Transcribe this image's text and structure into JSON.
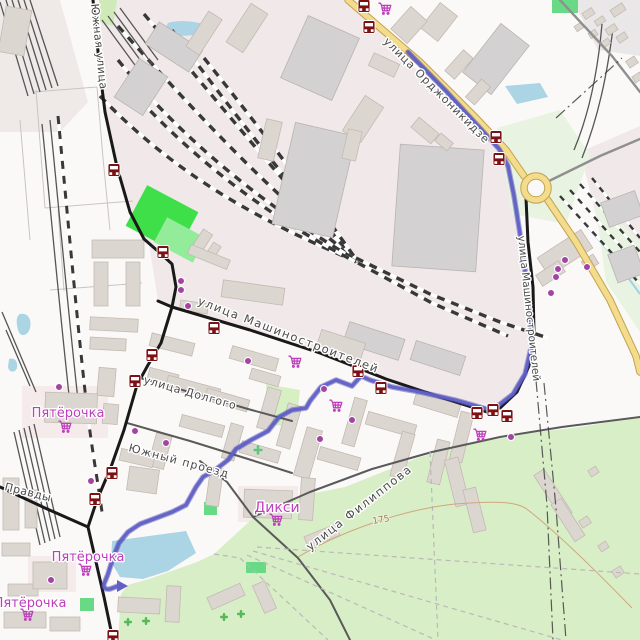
{
  "colors": {
    "bg": "#fbf9f8",
    "industrial": "#f1e9e9",
    "water": "#abd4e4",
    "stream": "#9fd4e4",
    "park": "#d8eec7",
    "pale_green": "#e9f3e1",
    "building": "#dcd6d1",
    "building_stroke": "#c3bab2",
    "industrial_building": "#d3d1d1",
    "industrial_building_stroke": "#b9b4b1",
    "road_black": "#191919",
    "road_minor": "#5a5a5a",
    "road_gray": "#8f8f8f",
    "road_yellow": "#f4dc8d",
    "road_yellow_casing": "#c2a24f",
    "rail_dark": "#383838",
    "rail_thin": "#555555",
    "route": "#6060c8",
    "route_casing": "#3e3ea8",
    "poi_purple": "#a344a3",
    "shop_label": "#bc3fbc",
    "bus_icon": "#7c1013",
    "street_label": "#4a4a4a",
    "boundary": "#3f3f3f",
    "field_path": "#c9c4bf",
    "contour": "#cfa87c",
    "contour_label": "#a87a4e",
    "green_icon": "#57b857",
    "playground_icon": "#57c87a",
    "field_green": "#3fdf4a",
    "field_green_light": "#93ec9a",
    "green_patch": "#68da86",
    "hedge": "#cfeab8",
    "hedge2": "#d6f0c4",
    "zone_retail": "#f5ebea",
    "zone_gray": "#e9e7e7",
    "zone_nw": "#efeae8"
  },
  "street_labels": [
    {
      "text": "Южная улица",
      "x": 91,
      "y": 4,
      "rot": 84,
      "size": 11,
      "ls": 0.5
    },
    {
      "text": "улица Орджоникидзе",
      "x": 383,
      "y": 42,
      "rot": 45,
      "size": 11,
      "ls": 1
    },
    {
      "text": "улица Машиностроителей",
      "x": 197,
      "y": 304,
      "rot": 21,
      "size": 11.5,
      "ls": 1.5
    },
    {
      "text": "улица Машиностроителей",
      "x": 518,
      "y": 236,
      "rot": 84,
      "size": 10.5,
      "ls": 0
    },
    {
      "text": "улица Долгого",
      "x": 143,
      "y": 383,
      "rot": 16,
      "size": 11,
      "ls": 0.8
    },
    {
      "text": "Южный проезд",
      "x": 128,
      "y": 451,
      "rot": 15,
      "size": 11,
      "ls": 1.2
    },
    {
      "text": "Правды",
      "x": 4,
      "y": 490,
      "rot": 14,
      "size": 11,
      "ls": 0.5
    },
    {
      "text": "улица Филиппова",
      "x": 310,
      "y": 551,
      "rot": -38,
      "size": 11.5,
      "ls": 1.5
    }
  ],
  "shop_labels": [
    {
      "text": "Пятёрочка",
      "x": 68,
      "y": 417,
      "size": 13
    },
    {
      "text": "Пятёрочка",
      "x": 88,
      "y": 561,
      "size": 13
    },
    {
      "text": "Пятёрочка",
      "x": 30,
      "y": 607,
      "size": 13
    },
    {
      "text": "Дикси",
      "x": 277,
      "y": 512,
      "size": 14
    }
  ],
  "carts": [
    [
      385,
      10
    ],
    [
      295,
      363
    ],
    [
      336,
      407
    ],
    [
      480,
      436
    ],
    [
      65,
      428
    ],
    [
      85,
      571
    ],
    [
      27,
      616
    ],
    [
      276,
      521
    ]
  ],
  "shop_dots": [
    [
      181,
      281
    ],
    [
      181,
      290
    ],
    [
      188,
      306
    ],
    [
      248,
      361
    ],
    [
      324,
      389
    ],
    [
      352,
      420
    ],
    [
      320,
      439
    ],
    [
      511,
      437
    ],
    [
      565,
      260
    ],
    [
      558,
      269
    ],
    [
      556,
      277
    ],
    [
      587,
      267
    ],
    [
      551,
      293
    ],
    [
      59,
      387
    ],
    [
      135,
      431
    ],
    [
      166,
      443
    ],
    [
      91,
      481
    ],
    [
      51,
      580
    ]
  ],
  "bus_stops": [
    [
      364,
      6
    ],
    [
      369,
      27
    ],
    [
      496,
      137
    ],
    [
      499,
      159
    ],
    [
      114,
      170
    ],
    [
      163,
      252
    ],
    [
      214,
      328
    ],
    [
      152,
      355
    ],
    [
      358,
      371
    ],
    [
      381,
      388
    ],
    [
      135,
      381
    ],
    [
      112,
      473
    ],
    [
      95,
      499
    ],
    [
      477,
      413
    ],
    [
      493,
      410
    ],
    [
      507,
      416
    ],
    [
      113,
      636
    ]
  ],
  "route": {
    "d": "M408,52 L445,90 L478,126 L499,149 L508,166 L514,196 L521,240 L527,285 L531,325 L531,348 L525,374 L513,394 L499,405 L487,409 L455,400 L420,392 L392,387 L370,380 L361,376 L352,386 L336,380 L321,387 L310,401 L306,408 L292,410 L279,417 L268,431 L251,440 L236,449 L228,460 L215,470 L203,477 L196,487 L186,505 L172,512 L156,518 L140,524 L128,532 L119,543 L113,558 L108,574 L104,584 Q103,590 110,589 L118,586",
    "arrow": "117,580 128,586 117,592"
  },
  "contour": {
    "d": "M298,557 C340,532 400,510 455,504 C505,500 520,503 528,510 C560,535 600,575 632,608",
    "label": "175",
    "x": 373,
    "y": 524,
    "rot": -10
  },
  "areas": [
    {
      "d": "M100,0 L348,0 L492,146 L506,161 L521,232 L534,330 L520,382 L496,406 L440,397 L386,379 L250,330 L172,307 L158,301 L149,244 L130,212 L117,167 L104,112 Z",
      "f": "industrial"
    },
    {
      "d": "M580,152 L640,126 L640,264 L598,222 Z",
      "f": "industrial"
    },
    {
      "d": "M0,0 L60,0 L88,102 L60,132 L0,132 Z",
      "f": "zone_nw"
    },
    {
      "d": "M572,0 L640,0 L640,56 L598,50 Z",
      "f": "zone_gray"
    },
    {
      "d": "M22,386 L108,386 L108,438 L22,438 Z",
      "f": "zone_retail"
    },
    {
      "d": "M28,556 L76,556 L76,592 L28,592 Z",
      "f": "zone_retail"
    },
    {
      "d": "M238,486 L298,486 L298,522 L238,522 Z",
      "f": "zone_retail"
    },
    {
      "d": "M118,640 L121,594 L128,585 L152,578 L197,562 L214,554 L252,519 L300,496 L345,487 L420,457 L470,444 L530,433 L580,427 L640,417 L640,640 Z",
      "f": "park"
    },
    {
      "d": "M497,128 L560,110 L590,155 L566,224 L512,214 Z",
      "f": "pale_green"
    },
    {
      "d": "M594,196 L640,242 L640,332 L606,282 Z",
      "f": "pale_green"
    },
    {
      "d": "M540,505 L556,478 L582,600 L585,640 L548,640 Z",
      "f": "park"
    },
    {
      "d": "M572,520 L594,504 L614,570 L594,614 Z",
      "f": "park"
    }
  ],
  "hedges": [
    {
      "d": "M99,0 L117,0 L113,26 L99,22 Z",
      "f": "hedge"
    },
    {
      "d": "M266,384 L300,390 L296,428 L268,424 Z",
      "f": "hedge2"
    }
  ],
  "green_rects": [
    [
      133,
      196,
      58,
      46,
      28,
      "field_green"
    ],
    [
      158,
      226,
      44,
      28,
      28,
      "field_green_light"
    ],
    [
      552,
      0,
      26,
      13,
      0,
      "green_patch"
    ],
    [
      204,
      502,
      13,
      13,
      0,
      "green_patch"
    ],
    [
      246,
      562,
      20,
      11,
      0,
      "green_patch"
    ],
    [
      80,
      598,
      14,
      13,
      0,
      "green_patch"
    ]
  ],
  "trees": [
    [
      128,
      622
    ],
    [
      146,
      621
    ],
    [
      224,
      617
    ],
    [
      241,
      614
    ]
  ],
  "playgrounds": [
    [
      258,
      450
    ]
  ],
  "water": [
    {
      "d": "M112,541 L186,531 L196,553 L168,571 L143,579 L120,577 L111,562 Z"
    },
    {
      "d": "M168,23 C180,19 205,22 211,28 C206,35 186,37 172,35 C166,32 165,27 168,23 Z"
    },
    {
      "d": "M505,86 L540,83 L548,97 L517,104 Z"
    },
    {
      "d": "M20,314 C28,312 32,320 30,328 C28,336 20,338 18,330 C16,322 16,316 20,314 Z"
    },
    {
      "d": "M9,359 C15,357 18,362 17,368 C15,373 9,373 8,367 Z"
    }
  ],
  "streams": [
    "M576,214 L608,250 L640,294"
  ],
  "rails": [
    {
      "d": "M118,26 C200,118 282,205 356,259",
      "t": "y"
    },
    {
      "d": "M144,14 C226,112 300,203 356,259",
      "t": "y"
    },
    {
      "d": "M172,30 C240,122 308,208 357,261",
      "t": "y"
    },
    {
      "d": "M204,58 C262,130 320,208 358,262",
      "t": "y"
    },
    {
      "d": "M118,60 C190,150 280,215 356,260",
      "t": "y"
    },
    {
      "d": "M100,96 C180,180 270,225 355,261",
      "t": "y"
    },
    {
      "d": "M140,100 C210,175 286,226 356,262",
      "t": "y"
    },
    {
      "d": "M356,258 L430,294 L500,322 L548,338",
      "t": "y"
    },
    {
      "d": "M358,263 L432,303 L508,336",
      "t": "y"
    },
    {
      "d": "M560,196 L640,284",
      "t": "c"
    },
    {
      "d": "M570,190 L640,268",
      "t": "c"
    },
    {
      "d": "M580,184 L640,252",
      "t": "c"
    },
    {
      "d": "M592,178 L640,238",
      "t": "c"
    },
    {
      "d": "M602,24 C598,70 590,112 574,150",
      "t": "s"
    },
    {
      "d": "M613,28 C607,76 598,118 582,158",
      "t": "s"
    },
    {
      "d": "M58,116 C68,220 76,310 86,400 C92,452 98,482 102,512",
      "t": "m"
    },
    {
      "d": "M50,120 C60,220 68,310 78,400",
      "t": "s"
    },
    {
      "d": "M42,124 C52,224 60,314 70,404",
      "t": "s"
    },
    {
      "d": "M14,432 L40,545",
      "t": "s"
    },
    {
      "d": "M19,430 L45,543",
      "t": "s"
    },
    {
      "d": "M24,428 L50,541",
      "t": "s"
    },
    {
      "d": "M29,426 L55,539",
      "t": "s"
    },
    {
      "d": "M34,424 L60,537",
      "t": "s"
    },
    {
      "d": "M0,2 L28,96",
      "t": "s"
    },
    {
      "d": "M6,0 L34,94",
      "t": "s"
    },
    {
      "d": "M12,0 L40,92",
      "t": "s"
    },
    {
      "d": "M18,0 L46,90",
      "t": "s"
    },
    {
      "d": "M24,0 L52,88",
      "t": "s"
    },
    {
      "d": "M30,0 L58,86",
      "t": "s"
    },
    {
      "d": "M102,20 L140,72",
      "t": "s"
    },
    {
      "d": "M108,16 L146,68",
      "t": "s"
    },
    {
      "d": "M114,12 L152,64",
      "t": "s"
    },
    {
      "d": "M120,8 L158,60",
      "t": "s"
    },
    {
      "d": "M2,312 L36,392",
      "t": "s"
    },
    {
      "d": "M6,330 L30,386",
      "t": "s"
    }
  ],
  "roads": {
    "minor": [
      "M140,378 L200,395 L248,409 L292,421",
      "M127,423 L190,441 L248,459 L292,473",
      "M253,517 L310,492 L372,469 L432,452 L500,437 L562,427 L640,417",
      "M200,461 L227,482 L253,517 L298,558 L330,600 L350,640"
    ],
    "gray": [
      "M549,181 L600,156 L640,139",
      "M560,0 L612,56 L640,92"
    ],
    "black": [
      "M93,0 L100,72 L105,112 L117,167 L130,212 L144,239 L160,253 L172,264 L176,287 L172,307 L161,343 L148,365 L137,385 L124,430 L111,467 L97,500 L88,527",
      "M88,527 L96,562 L104,597 L113,640",
      "M158,301 L172,307 L250,330 L320,353 L386,379 L440,397 L487,412",
      "M526,198 L528,242 L533,287 L534,332 L529,366 L517,392 L500,408 L487,412",
      "M0,487 L45,508 L88,527"
    ],
    "yellow": [
      "M348,0 L420,62 L476,118 L506,150 L524,176",
      "M547,199 L576,242 L610,300 L636,356 L640,372"
    ]
  },
  "roundabout": {
    "cx": 536,
    "cy": 188,
    "r": 12
  },
  "boundaries": [
    "M536,380 L547,505 L553,640",
    "M544,383 L556,508 L566,640",
    "M556,118 L622,58"
  ],
  "field_paths": [
    "M33,92 L97,87",
    "M36,90 L45,208",
    "M45,208 L133,201",
    "M50,290 L142,283",
    "M97,87 L103,158",
    "M103,158 L110,230",
    "M58,209 L64,291",
    "M20,120 L30,240"
  ],
  "park_paths": [
    "M240,558 L328,640",
    "M247,555 L436,640",
    "M253,551 L562,640",
    "M257,547 L640,574",
    "M214,554 L240,558",
    "M430,452 L438,640"
  ],
  "buildings": [
    [
      148,
      34,
      52,
      26,
      33,
      "i"
    ],
    [
      124,
      64,
      34,
      46,
      33,
      "i"
    ],
    [
      196,
      12,
      16,
      42,
      33
    ],
    [
      237,
      5,
      20,
      46,
      33
    ],
    [
      292,
      24,
      56,
      68,
      24,
      "i"
    ],
    [
      283,
      128,
      62,
      104,
      13,
      "i"
    ],
    [
      396,
      147,
      84,
      122,
      4,
      "i"
    ],
    [
      352,
      98,
      22,
      42,
      33
    ],
    [
      412,
      124,
      26,
      13,
      40
    ],
    [
      436,
      137,
      16,
      10,
      40
    ],
    [
      478,
      28,
      36,
      62,
      38,
      "i"
    ],
    [
      428,
      6,
      22,
      32,
      38
    ],
    [
      370,
      58,
      28,
      14,
      25
    ],
    [
      196,
      230,
      11,
      24,
      33
    ],
    [
      208,
      243,
      9,
      18,
      33
    ],
    [
      188,
      252,
      42,
      10,
      22
    ],
    [
      262,
      120,
      16,
      40,
      13
    ],
    [
      345,
      130,
      14,
      30,
      13
    ],
    [
      583,
      10,
      11,
      7,
      -33
    ],
    [
      595,
      18,
      10,
      6,
      -33
    ],
    [
      606,
      26,
      11,
      7,
      -33
    ],
    [
      617,
      34,
      10,
      7,
      -33
    ],
    [
      589,
      31,
      8,
      6,
      -33
    ],
    [
      601,
      40,
      9,
      6,
      -33
    ],
    [
      575,
      24,
      8,
      6,
      -33
    ],
    [
      611,
      6,
      14,
      8,
      -33
    ],
    [
      627,
      58,
      10,
      8,
      -33
    ],
    [
      633,
      74,
      9,
      7,
      -33
    ],
    [
      539,
      242,
      52,
      22,
      -33
    ],
    [
      537,
      267,
      27,
      13,
      -33
    ],
    [
      583,
      257,
      14,
      11,
      -33
    ],
    [
      604,
      196,
      36,
      26,
      -20,
      "i"
    ],
    [
      612,
      249,
      28,
      30,
      -20,
      "i"
    ],
    [
      92,
      240,
      52,
      18,
      0
    ],
    [
      94,
      262,
      14,
      44,
      0
    ],
    [
      126,
      262,
      14,
      44,
      0
    ],
    [
      90,
      318,
      48,
      13,
      3
    ],
    [
      90,
      338,
      36,
      12,
      3
    ],
    [
      98,
      368,
      17,
      28,
      5
    ],
    [
      103,
      404,
      15,
      20,
      5
    ],
    [
      148,
      371,
      30,
      12,
      15
    ],
    [
      166,
      382,
      54,
      13,
      15
    ],
    [
      205,
      394,
      44,
      12,
      16
    ],
    [
      150,
      338,
      44,
      13,
      14
    ],
    [
      222,
      284,
      62,
      17,
      8
    ],
    [
      180,
      302,
      28,
      10,
      8
    ],
    [
      230,
      352,
      48,
      13,
      16
    ],
    [
      180,
      420,
      44,
      12,
      15
    ],
    [
      152,
      434,
      16,
      34,
      15
    ],
    [
      226,
      424,
      13,
      36,
      16
    ],
    [
      250,
      372,
      30,
      11,
      16
    ],
    [
      262,
      388,
      14,
      42,
      16
    ],
    [
      282,
      404,
      14,
      44,
      16
    ],
    [
      240,
      446,
      40,
      12,
      16
    ],
    [
      120,
      452,
      34,
      12,
      13
    ],
    [
      300,
      428,
      16,
      50,
      16
    ],
    [
      318,
      452,
      42,
      13,
      16
    ],
    [
      348,
      398,
      13,
      48,
      16
    ],
    [
      366,
      418,
      50,
      13,
      16
    ],
    [
      396,
      432,
      13,
      46,
      16
    ],
    [
      414,
      398,
      46,
      13,
      17
    ],
    [
      432,
      440,
      13,
      44,
      14
    ],
    [
      455,
      412,
      13,
      50,
      14
    ],
    [
      345,
      330,
      58,
      22,
      18,
      "i"
    ],
    [
      412,
      348,
      52,
      20,
      18,
      "i"
    ],
    [
      318,
      336,
      46,
      18,
      18
    ],
    [
      244,
      490,
      48,
      28,
      2
    ],
    [
      300,
      478,
      14,
      42,
      4
    ],
    [
      208,
      468,
      13,
      38,
      8
    ],
    [
      305,
      530,
      34,
      12,
      -22
    ],
    [
      450,
      458,
      14,
      48,
      -14
    ],
    [
      468,
      488,
      13,
      44,
      -14
    ],
    [
      547,
      468,
      12,
      52,
      -33
    ],
    [
      562,
      498,
      12,
      44,
      -33
    ],
    [
      4,
      612,
      42,
      16,
      0
    ],
    [
      50,
      617,
      30,
      14,
      0
    ],
    [
      8,
      584,
      30,
      12,
      0
    ],
    [
      33,
      562,
      34,
      27,
      0
    ],
    [
      118,
      598,
      42,
      15,
      3
    ],
    [
      166,
      586,
      14,
      36,
      3
    ],
    [
      208,
      590,
      36,
      13,
      -24
    ],
    [
      258,
      582,
      13,
      30,
      -24
    ],
    [
      128,
      468,
      30,
      24,
      8
    ],
    [
      3,
      478,
      16,
      52,
      0
    ],
    [
      25,
      490,
      12,
      38,
      0
    ],
    [
      2,
      543,
      28,
      13,
      0
    ],
    [
      45,
      393,
      52,
      30,
      2
    ],
    [
      580,
      518,
      10,
      8,
      -33
    ],
    [
      599,
      543,
      9,
      7,
      -33
    ],
    [
      613,
      568,
      10,
      8,
      -33
    ],
    [
      589,
      468,
      9,
      7,
      -33
    ],
    [
      2,
      8,
      26,
      46,
      10
    ],
    [
      394,
      14,
      30,
      22,
      -48
    ],
    [
      445,
      58,
      28,
      13,
      -48
    ],
    [
      466,
      86,
      24,
      12,
      -48
    ]
  ]
}
